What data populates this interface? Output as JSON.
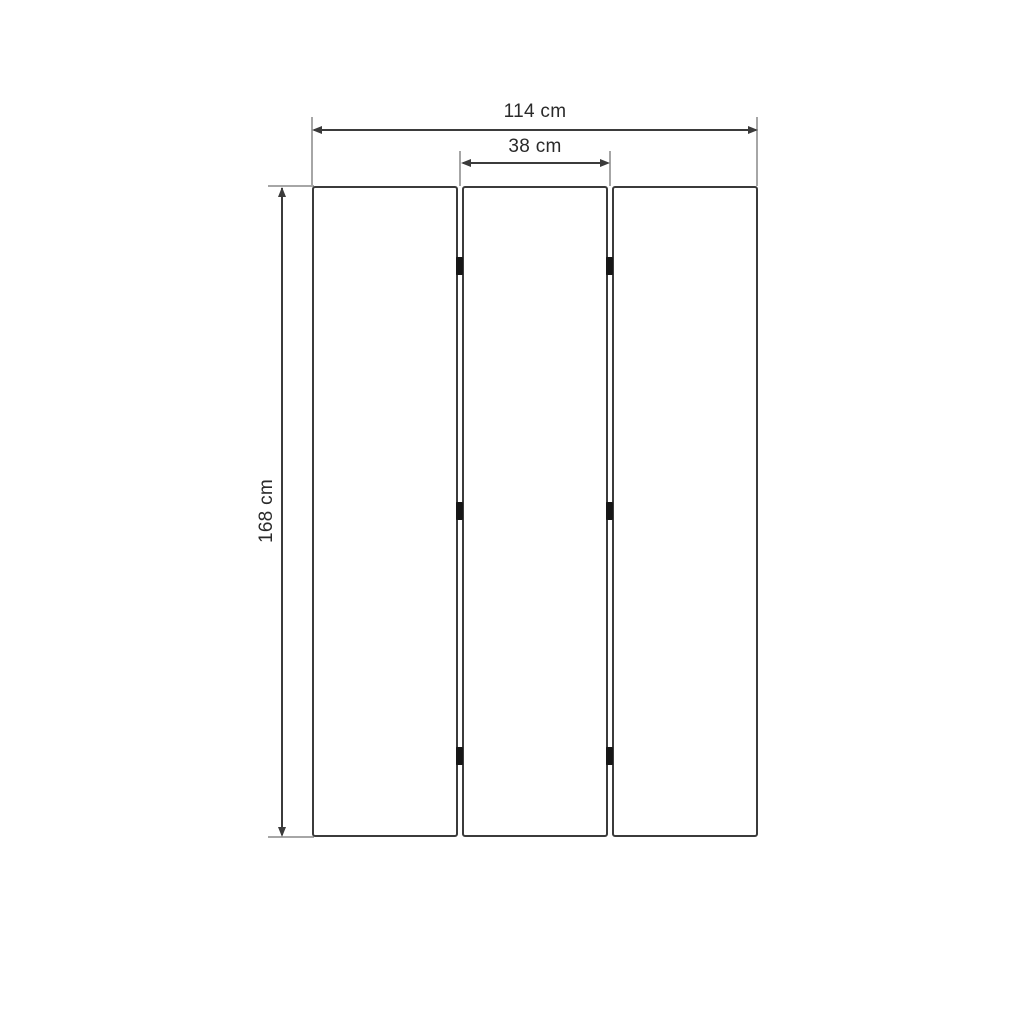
{
  "diagram": {
    "type": "dimension-drawing",
    "subject": "three-panel folding screen front view",
    "panel_count": 3,
    "hinges_per_seam": 3,
    "dimensions": {
      "total_width": {
        "label": "114 cm",
        "value": 114,
        "unit": "cm"
      },
      "panel_width": {
        "label": "38 cm",
        "value": 38,
        "unit": "cm"
      },
      "total_height": {
        "label": "168 cm",
        "value": 168,
        "unit": "cm"
      }
    },
    "colors": {
      "background": "#ffffff",
      "panel_outline": "#3b3b3b",
      "dimension_line": "#3b3b3b",
      "extension_line": "#a6a6a6",
      "hinge": "#161616",
      "text": "#2a2a2a"
    }
  }
}
